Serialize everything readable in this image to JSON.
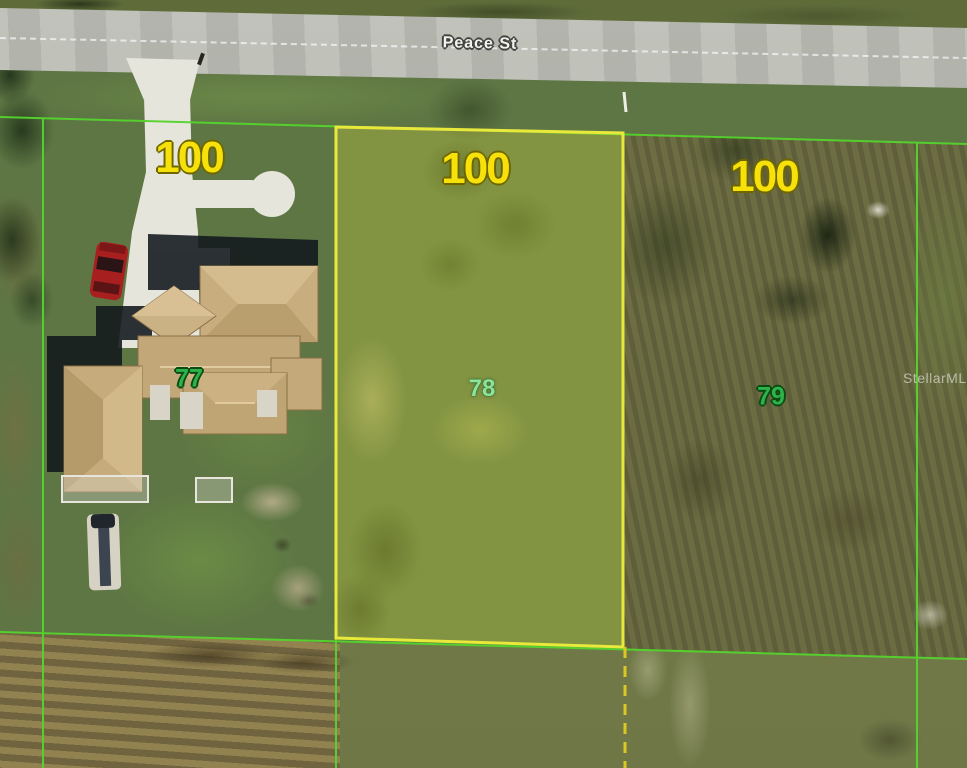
{
  "map": {
    "street_label": "Peace St",
    "watermark": "StellarMLS",
    "parcels": [
      {
        "id": "77",
        "lot_width": "100",
        "highlighted": false
      },
      {
        "id": "78",
        "lot_width": "100",
        "highlighted": true
      },
      {
        "id": "79",
        "lot_width": "100",
        "highlighted": false
      }
    ],
    "colors": {
      "boundary_green": "#55d42e",
      "parcel_highlight_outline": "#e9e93c",
      "parcel_highlight_fill": "rgba(228,228,60,0.28)",
      "lot_width_text": "#f6e20a",
      "parcel_number_text": "#2eb34a",
      "street_text": "#f2f2f2",
      "dashed_survey_line": "#ddc722",
      "road_gray": "#b8bab2",
      "roof_tan": "#c6ac7c"
    }
  }
}
